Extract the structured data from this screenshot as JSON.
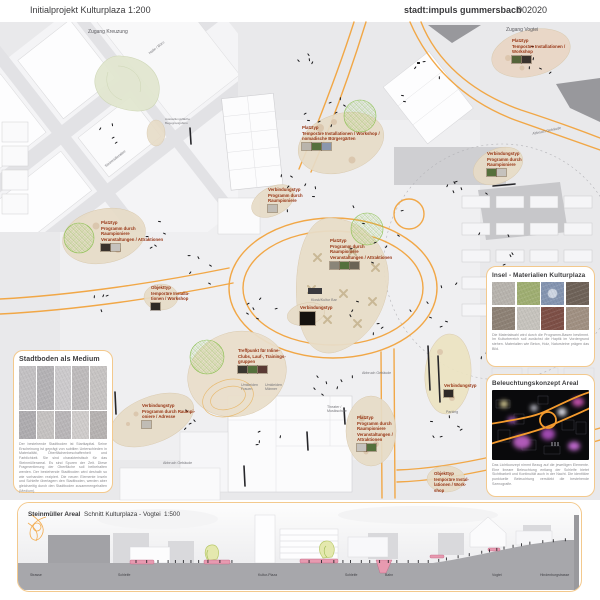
{
  "header": {
    "title": "Initialprojekt Kulturplaza 1:200",
    "studio": "stadt:impuls gummersbach",
    "code": "002020"
  },
  "plan": {
    "annotations": [
      {
        "x": 512,
        "y": 38,
        "text": "Platztyp\nTemporäre Installationen /\nWorkshop",
        "swatches": [
          "#55643a",
          "#3a322c"
        ]
      },
      {
        "x": 302,
        "y": 125,
        "text": "Platztyp\nTemporäre Installationen / Workshop /\nnomadische Bürgergärten",
        "swatches": [
          "#b9b4ac",
          "#55703c",
          "#8a97ad"
        ]
      },
      {
        "x": 487,
        "y": 151,
        "text": "Verbindungstyp\nProgramm durch\nRaumpioniere",
        "swatches": [
          "#55703c",
          "#c5c2bd"
        ]
      },
      {
        "x": 268,
        "y": 187,
        "text": "Verbindungstyp\nProgramm durch\nRaumpioniere",
        "swatches": [
          "#c0bcb5"
        ]
      },
      {
        "x": 101,
        "y": 220,
        "text": "Platztyp\nProgramm durch\nRaumpioniere\nVeranstaltungen / Attraktionen",
        "swatches": [
          "#3a322c",
          "#c5c2bd"
        ]
      },
      {
        "x": 330,
        "y": 238,
        "text": "Platztyp\nProgramm durch\nRaumpioniere\nVeranstaltungen / Attraktionen",
        "swatches": [
          "#8a8578",
          "#55703c",
          "#6b6455"
        ]
      },
      {
        "x": 151,
        "y": 285,
        "text": "Objekttyp\ntemporäre Installa-\ntionen / Workshop",
        "swatches": [
          "#2e2a26"
        ]
      },
      {
        "x": 300,
        "y": 305,
        "text": "Verbindungstyp",
        "swatches": [
          "#15120f"
        ],
        "qr": true
      },
      {
        "x": 238,
        "y": 348,
        "text": "Treffpunkt für Inline-\nClubs, Lauf-, Trainings-\ngruppen",
        "swatches": [
          "#3a362f",
          "#55703c",
          "#5a3a34"
        ]
      },
      {
        "x": 444,
        "y": 383,
        "text": "Verbindungstyp",
        "swatches": [
          "#2e2a26"
        ]
      },
      {
        "x": 142,
        "y": 403,
        "text": "Verbindungstyp\nProgramm durch Raumpi-\noniere / Adresse",
        "swatches": [
          "#c0bcb5"
        ]
      },
      {
        "x": 357,
        "y": 415,
        "text": "Platztyp\nProgramm durch\nRaumpioniere\nVeranstaltungen /\nAttraktionen",
        "swatches": [
          "#c5c2bd",
          "#55703c"
        ]
      },
      {
        "x": 434,
        "y": 471,
        "text": "Objekttyp\ntemporäre Instal-\nlationen / Work-\nshop",
        "swatches": []
      }
    ],
    "labels": [
      {
        "x": 88,
        "y": 29,
        "text": "Zugang Kreuzung",
        "size": 5,
        "color": "#59595e"
      },
      {
        "x": 506,
        "y": 27,
        "text": "Zugang Vogtei",
        "size": 5,
        "color": "#59595e"
      },
      {
        "x": 148,
        "y": 52,
        "text": "Halle / Büro",
        "rot": -38
      },
      {
        "x": 532,
        "y": 132,
        "text": "Abbruch Gebäude",
        "rot": -12
      },
      {
        "x": 362,
        "y": 371,
        "text": "Abbruch Gebäude"
      },
      {
        "x": 163,
        "y": 461,
        "text": "Abbruch Gebäude"
      },
      {
        "x": 446,
        "y": 410,
        "text": "Parking"
      },
      {
        "x": 311,
        "y": 298,
        "text": "Kiosk/Kultur Bar"
      },
      {
        "x": 241,
        "y": 383,
        "text": "Umkleiden\nFrauen"
      },
      {
        "x": 265,
        "y": 383,
        "text": "Umkleiden\nMänner"
      },
      {
        "x": 327,
        "y": 405,
        "text": "Theater /\nMusikschule"
      },
      {
        "x": 104,
        "y": 165,
        "text": "Steinmüllerallee",
        "rot": -38
      },
      {
        "x": 165,
        "y": 118,
        "text": "Ausstellungsfläche\nBegegnungsbüro",
        "size": 3
      }
    ]
  },
  "panels": {
    "stadtboden": {
      "title": "Stadtboden als Medium",
      "tiles": [
        "#c3c1c3",
        "#b4b2b5",
        "#cccacc",
        "#bebbbc",
        "#c7c4c3",
        "#aeacaf",
        "#c5c2c1",
        "#b9b6b8",
        "#cfcccb",
        "#b6b2b1"
      ],
      "caption": "Der bestehende Stadtboden ist Startkapital. Seine Erscheinung ist geprägt von subtilen Unterschieden in Materialität, Oberflächenbeschaffenheit und Farblichkeit. Sie sind charakteristisch für das Steinmüllerareal. Es sind Spuren der Zeit. Diese Fragmentierung der Oberfläche soll beibehalten werden. Der bestehende Stadtboden wird deshalb so wie vorhanden rezipiert. Die neuen Elemente Inseln und Schleife überlagern den Stadtboden, werden aber gleichzeitig durch den Stadtboden zusammengehalten (Medium)."
    },
    "materialien": {
      "title": "Insel - Materialien Kulturplaza",
      "tiles": [
        {
          "c": "#b7b3ad"
        },
        {
          "c": "#9fae72"
        },
        {
          "c": "#8494b0",
          "inner": "#cdd5e2"
        },
        {
          "c": "#6e6258"
        },
        {
          "c": "#8d8175"
        },
        {
          "c": "#c6c3bd"
        },
        {
          "c": "#7d4f46"
        },
        {
          "c": "#a09082"
        }
      ],
      "caption": "Die Materialwahl wird durch die Programm-Basen bestimmt. Im Kulturbereich soll zunächst die Haptik im Vordergrund stehen. Materialien wie Beton, Holz, Natursteine prägen das Bild."
    },
    "beleuchtung": {
      "title": "Beleuchtungskonzept Areal",
      "caption": "Das Lichtkonzept nimmt Bezug auf die jeweiligen Elemente. Eine lineare Beleuchtung entlang der Schleife bietet Sichtbarkeit und Kontinuität auch in der Nacht. Die identitäre punktuelle Beleuchtung verstärkt die bestehende Szenografie."
    }
  },
  "section": {
    "area_title": "Steinmüller Areal",
    "drawing_title": "Schnitt Kulturplaza - Vogtei",
    "scale": "1:500",
    "ground_labels": [
      {
        "x": 12,
        "text": "Strasse"
      },
      {
        "x": 100,
        "text": "Schleife"
      },
      {
        "x": 240,
        "text": "Kultur-Plaza"
      },
      {
        "x": 327,
        "text": "Schleife"
      },
      {
        "x": 367,
        "text": "Bahn"
      },
      {
        "x": 474,
        "text": "Vogtei"
      },
      {
        "x": 522,
        "text": "Hindenburgstrasse"
      }
    ]
  },
  "colors": {
    "schleife_orange": "#F2A43E",
    "annotation_red": "#963312",
    "panel_border": "#F3C98D",
    "island_tan": "#E7DCC7",
    "tree_green": "#8CC152"
  }
}
